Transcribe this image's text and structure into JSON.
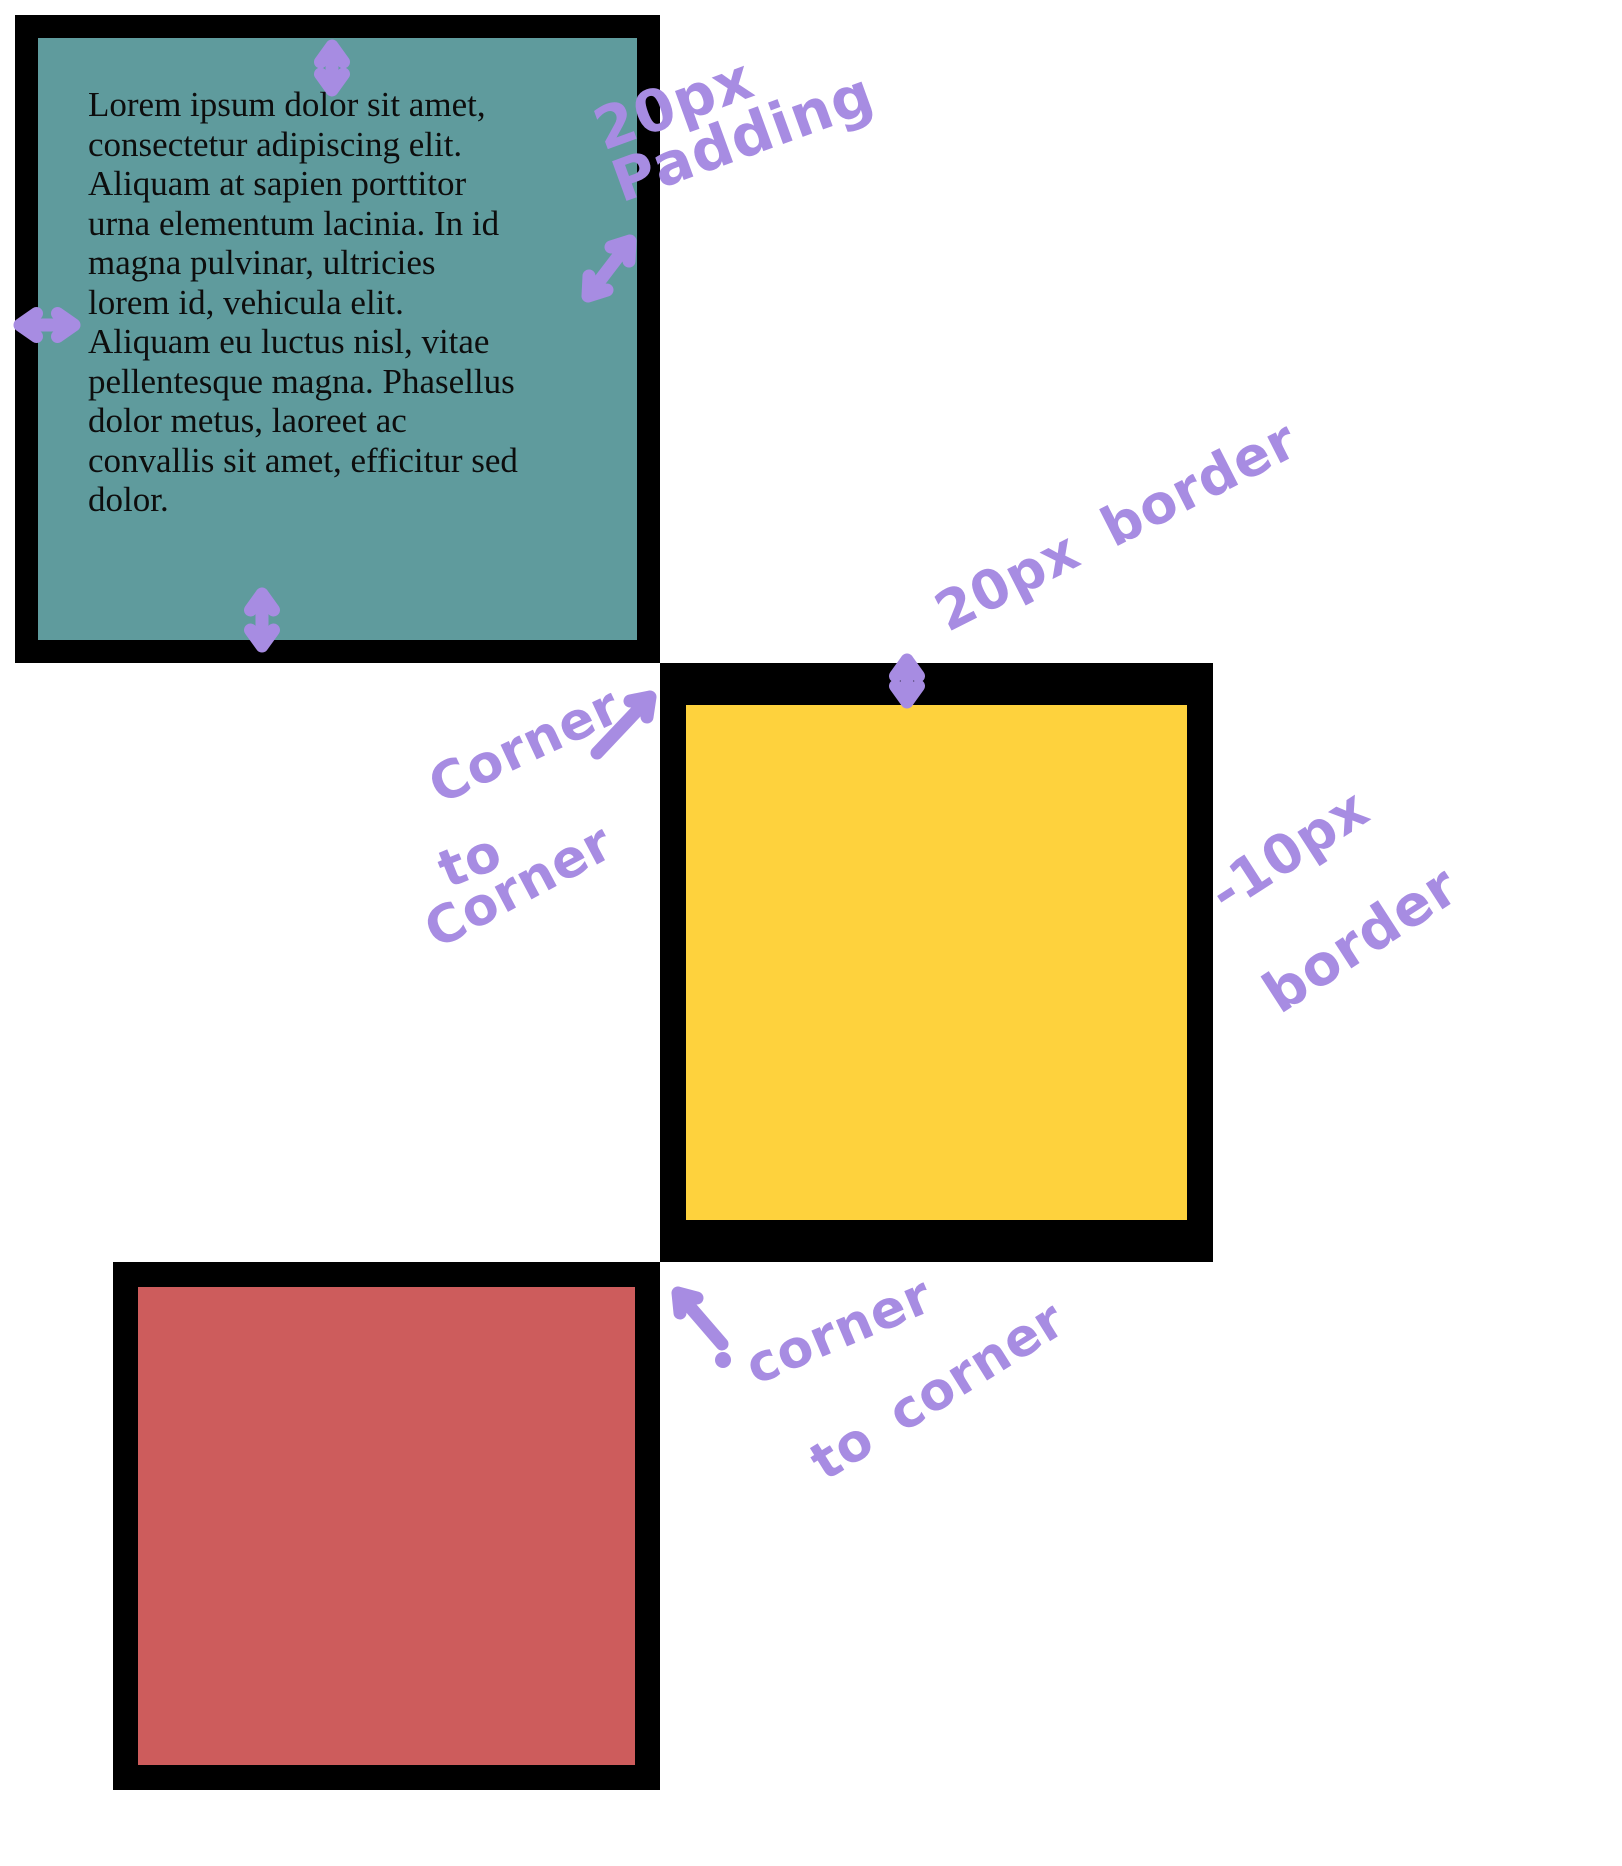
{
  "page": {
    "width": 1622,
    "height": 1866
  },
  "colors": {
    "page_background": "#ffffff",
    "border_black": "#000000",
    "teal_box": "#5f9b9d",
    "yellow_box": "#fed23d",
    "red_box": "#cd5c5c",
    "annotation_purple": "#a78ce2",
    "text_black": "#0d0d0d"
  },
  "teal_box": {
    "paragraph": "Lorem ipsum dolor sit amet,\nconsectetur adipiscing elit.\nAliquam at sapien porttitor\nurna elementum lacinia. In id\nmagna pulvinar, ultricies\nlorem id, vehicula elit.\nAliquam eu luctus nisl, vitae\npellentesque magna. Phasellus\ndolor metus, laoreet ac\nconvallis sit amet, efficitur sed\ndolor."
  },
  "annotations": {
    "padding": {
      "line1": "20px",
      "line2": "Padding"
    },
    "border_top": {
      "text": "20px border"
    },
    "border_right": {
      "line1": "-10px",
      "line2": "border"
    },
    "corner_top": {
      "word1": "Corner",
      "word2": "to",
      "word3": "Corner"
    },
    "corner_bottom": {
      "word1": "corner",
      "word2": "to corner"
    }
  },
  "icons": {
    "teal_top_padding_arrow": "vertical double-headed arrow",
    "teal_left_padding_arrow": "horizontal double-headed arrow",
    "teal_right_padding_arrow": "diagonal double-headed arrow",
    "teal_bottom_padding_arrow": "vertical double-headed arrow",
    "yellow_border_arrow": "vertical double-headed arrow",
    "corner_pointer_top": "arrow pointing up-right",
    "corner_pointer_bottom": "arrow pointing up-left with dot"
  }
}
